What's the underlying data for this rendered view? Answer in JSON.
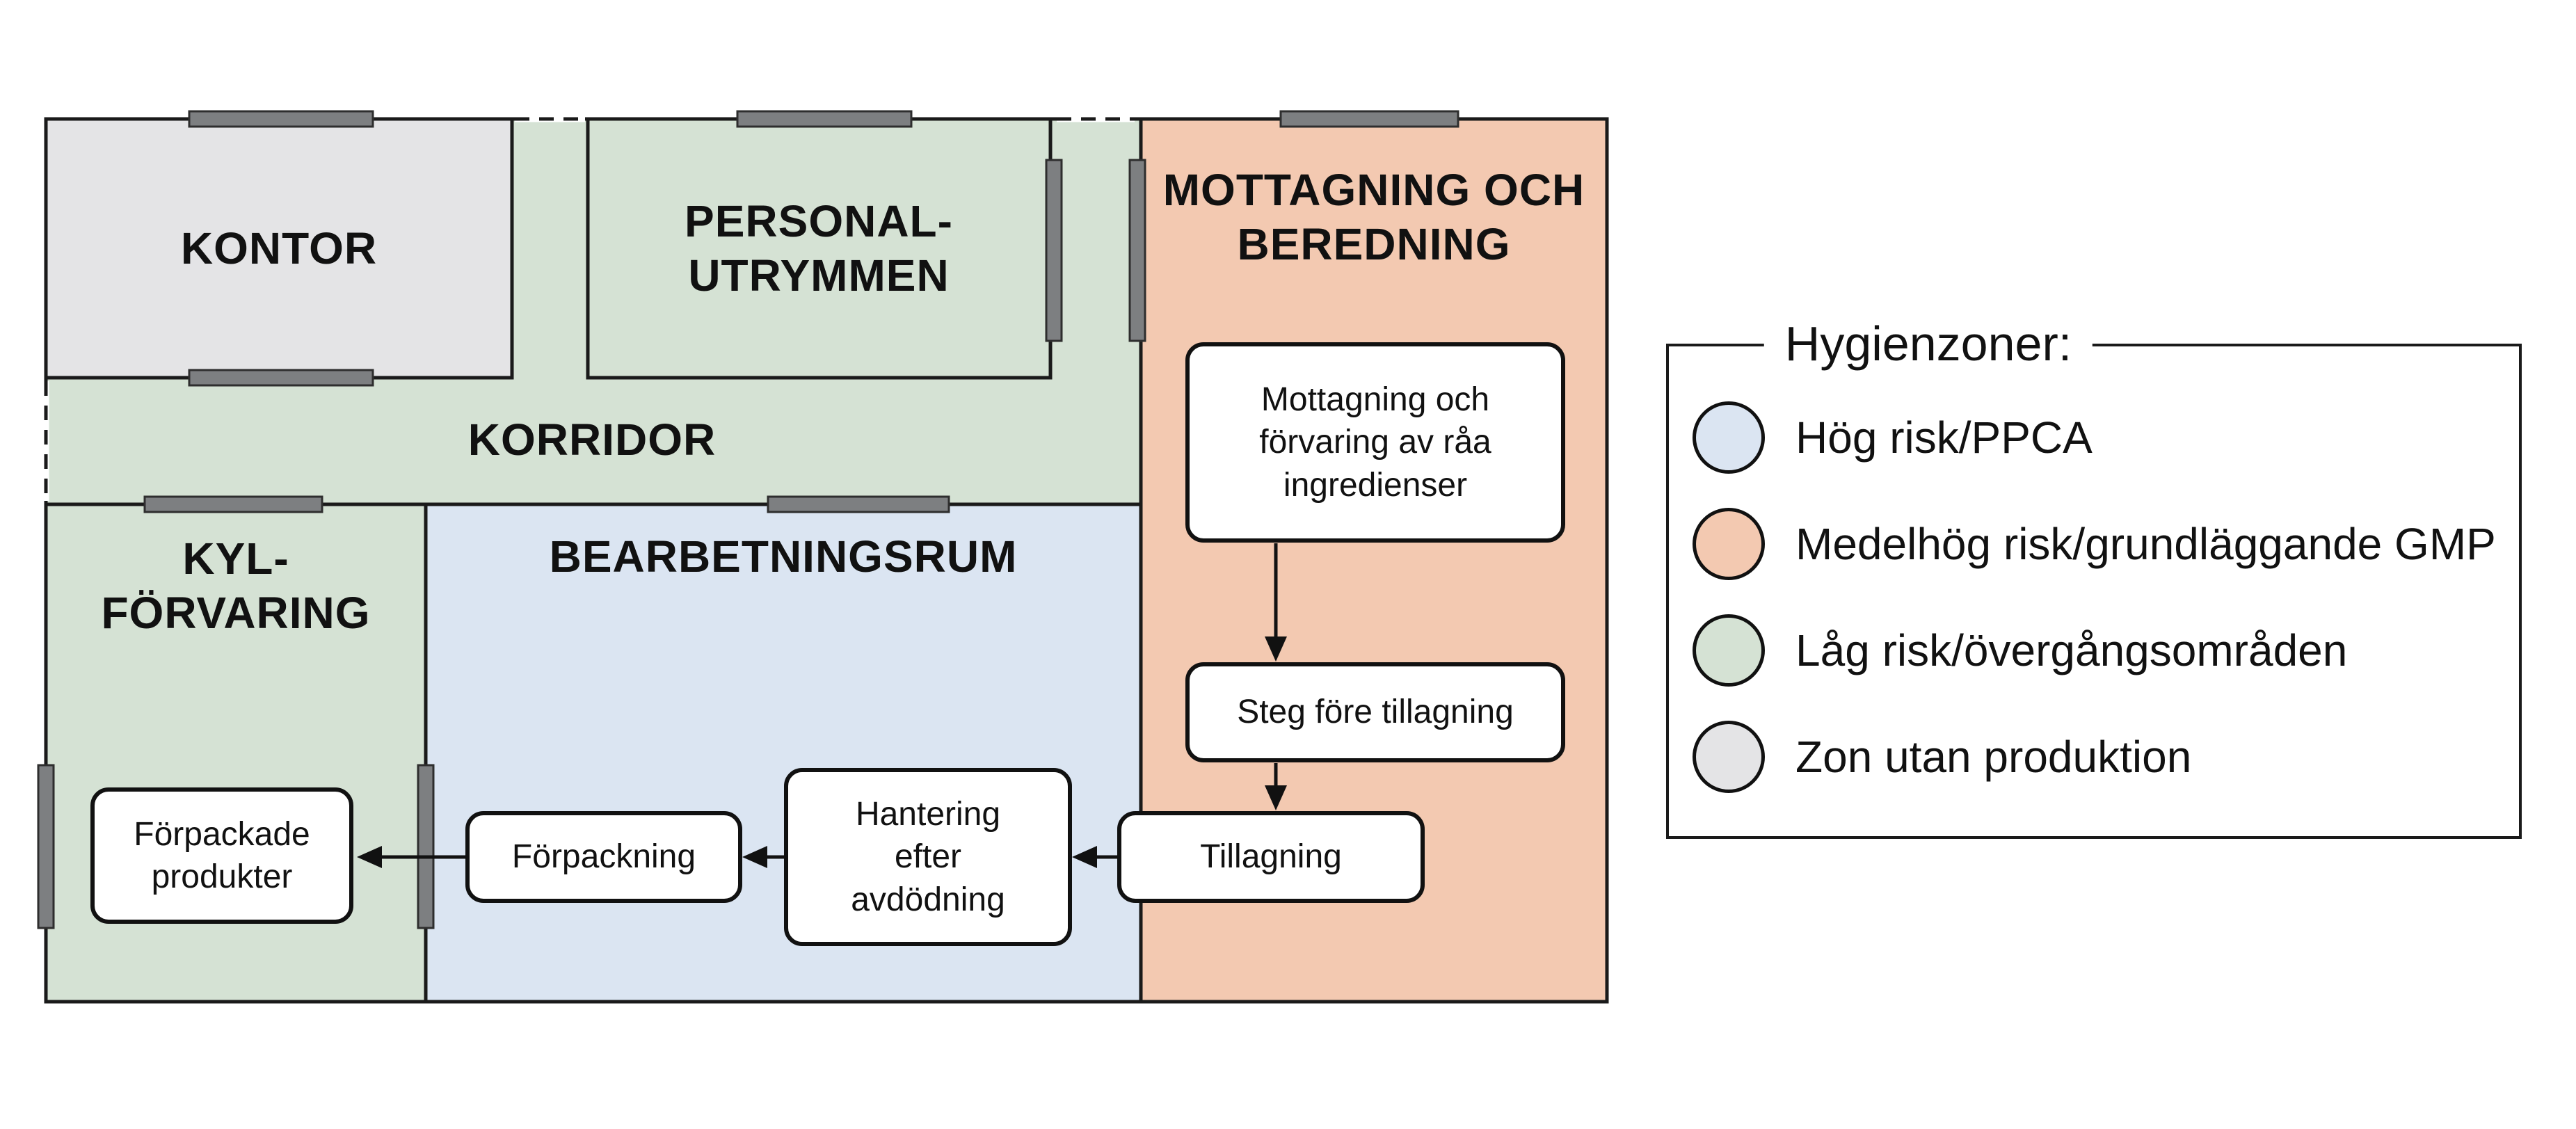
{
  "colors": {
    "zone_high_risk": "#DBE5F2",
    "zone_medium_risk": "#F3C9B1",
    "zone_low_risk": "#D5E2D4",
    "zone_no_production": "#E4E4E6",
    "wall": "#1A1A1A",
    "door_marker": "#7D7F81"
  },
  "rooms": [
    {
      "id": "kontor",
      "label": "KONTOR",
      "zone": "zone_no_production"
    },
    {
      "id": "personalutrymmen",
      "lines": [
        "PERSONAL-",
        "UTRYMMEN"
      ],
      "zone": "zone_low_risk"
    },
    {
      "id": "mottagning-och-beredning",
      "lines": [
        "MOTTAGNING OCH",
        "BEREDNING"
      ],
      "zone": "zone_medium_risk"
    },
    {
      "id": "korridor",
      "label": "KORRIDOR",
      "zone": "zone_low_risk"
    },
    {
      "id": "kylforvaring",
      "lines": [
        "KYL-",
        "FÖRVARING"
      ],
      "zone": "zone_low_risk"
    },
    {
      "id": "bearbetningsrum",
      "label": "BEARBETNINGSRUM",
      "zone": "zone_high_risk"
    }
  ],
  "flow": {
    "boxes": [
      {
        "id": "mottagning-forvaring",
        "lines": [
          "Mottagning och",
          "förvaring av råa",
          "ingredienser"
        ]
      },
      {
        "id": "steg-fore-tillagning",
        "lines": [
          "Steg före tillagning"
        ]
      },
      {
        "id": "tillagning",
        "lines": [
          "Tillagning"
        ]
      },
      {
        "id": "hantering-efter-avdodning",
        "lines": [
          "Hantering",
          "efter",
          "avdödning"
        ]
      },
      {
        "id": "forpackning",
        "lines": [
          "Förpackning"
        ]
      },
      {
        "id": "forpackade-produkter",
        "lines": [
          "Förpackade",
          "produkter"
        ]
      }
    ]
  },
  "legend": {
    "title": "Hygienzoner:",
    "items": [
      {
        "label": "Hög risk/PPCA",
        "color_key": "zone_high_risk"
      },
      {
        "label": "Medelhög risk/grundläggande GMP",
        "color_key": "zone_medium_risk"
      },
      {
        "label": "Låg risk/övergångsområden",
        "color_key": "zone_low_risk"
      },
      {
        "label": "Zon utan produktion",
        "color_key": "zone_no_production"
      }
    ]
  }
}
